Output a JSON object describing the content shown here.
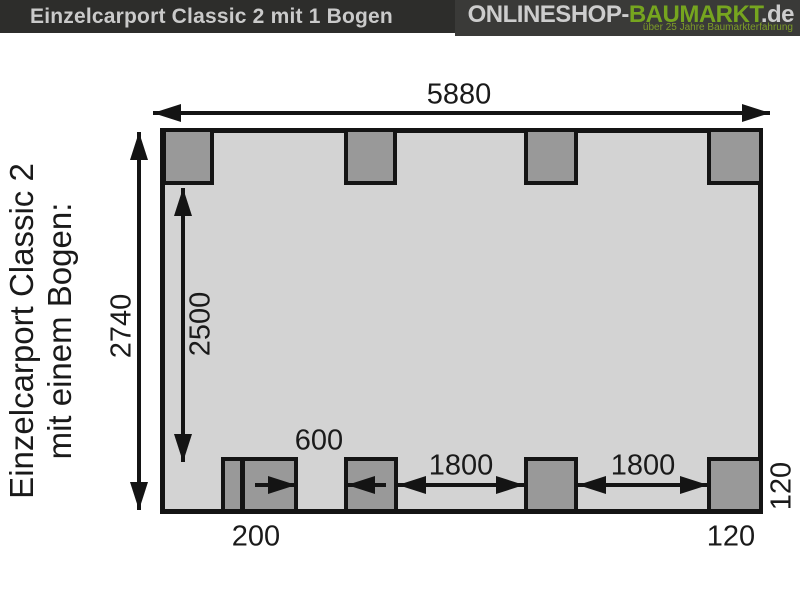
{
  "header": {
    "title": "Einzelcarport Classic 2 mit 1 Bogen",
    "logo": {
      "name_light": "ONLINESHOP-",
      "name_green": "BAUMARKT",
      "name_suffix": ".de",
      "tagline": "über 25 Jahre Baumarkterfahrung"
    }
  },
  "side_label": {
    "line1": "Einzelcarport Classic 2",
    "line2": "mit einem Bogen:"
  },
  "plan": {
    "dim_total_width": "5880",
    "dim_total_depth": "2740",
    "dim_inner_depth": "2500",
    "dim_post_gap": "600",
    "dim_bay_left": "1800",
    "dim_bay_right": "1800",
    "dim_offset_bottom_left": "200",
    "dim_post_bottom_right": "120",
    "dim_post_right_side": "120"
  },
  "colors": {
    "header_bg": "#2d2d2b",
    "logo_bg": "#3a3a38",
    "logo_green": "#76a51f",
    "logo_light": "#cdcdcd",
    "plan_fill": "#d3d3d3",
    "post_fill": "#999999",
    "line": "#141414"
  }
}
